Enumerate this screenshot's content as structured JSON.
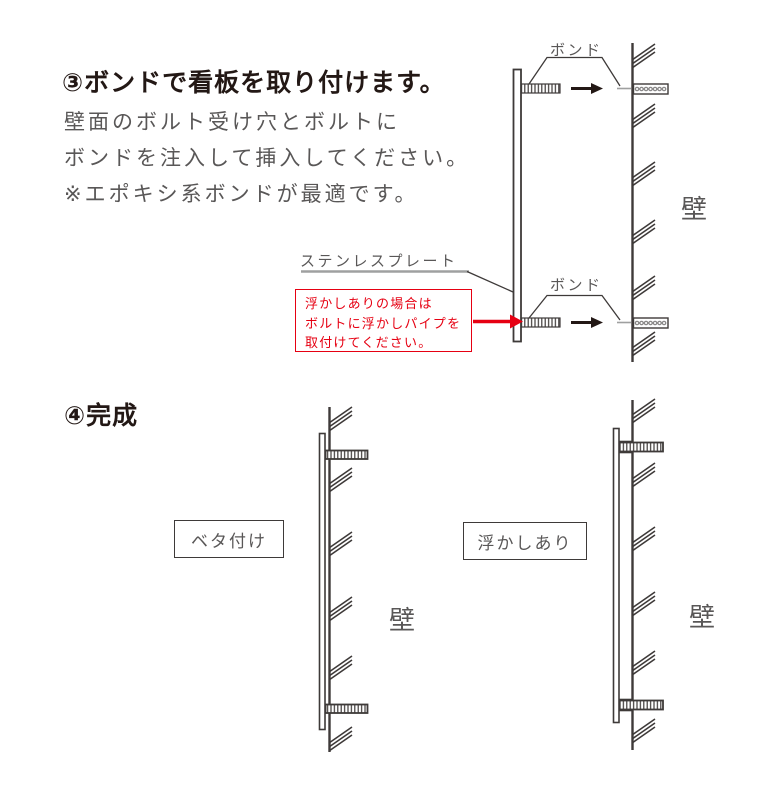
{
  "colors": {
    "heading": "#231815",
    "body_text": "#595757",
    "line_dark": "#3e3a39",
    "line_gray": "#9fa0a0",
    "accent_red": "#e60012",
    "background": "#ffffff"
  },
  "step3": {
    "heading": "③ボンドで看板を取り付けます。",
    "body_lines": [
      "壁面のボルト受け穴とボルトに",
      "ボンドを注入して挿入してください。",
      "※エポキシ系ボンドが最適です。"
    ],
    "bond_label_top": "ボンド",
    "bond_label_bottom": "ボンド",
    "plate_label": "ステンレスプレート",
    "note_lines": [
      "浮かしありの場合は",
      "ボルトに浮かしパイプを",
      "取付けてください。"
    ],
    "wall_label": "壁"
  },
  "step4": {
    "heading": "④完成",
    "flush_label": "ベタ付け",
    "standoff_label": "浮かしあり",
    "wall_label_left": "壁",
    "wall_label_right": "壁"
  }
}
